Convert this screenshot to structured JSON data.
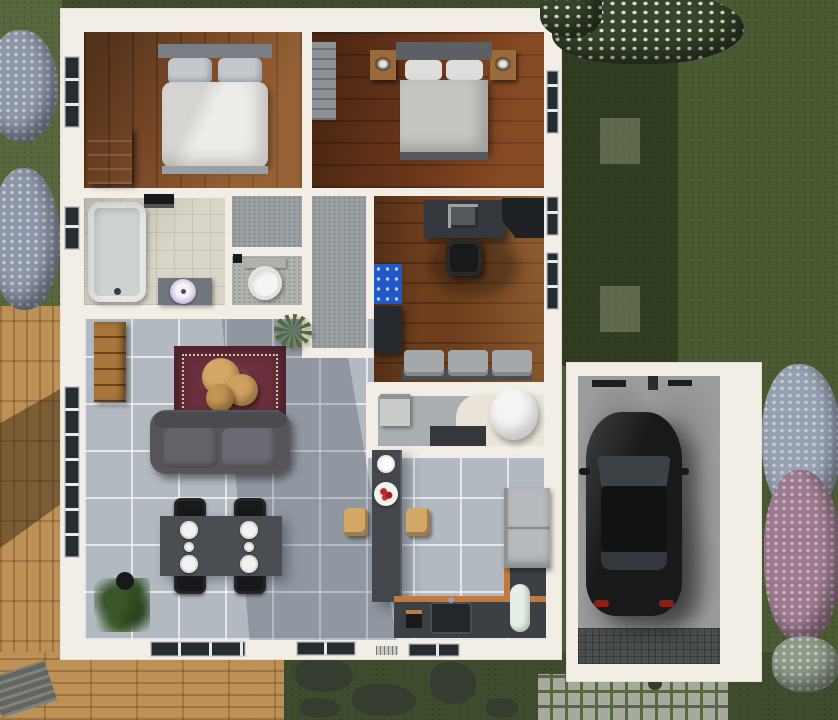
{
  "scene": {
    "kind": "3d-floorplan-render-top-view",
    "house": {
      "rooms": [
        "bedroom-left",
        "bedroom-right",
        "bathroom",
        "shower-room",
        "wc",
        "hallway",
        "office",
        "utility-room",
        "living-room",
        "dining-area",
        "kitchen",
        "garage"
      ]
    },
    "exterior": [
      "lawn",
      "wood-deck",
      "doormat",
      "stepping-stones",
      "cobblestone-driveway",
      "flowering-bushes",
      "tree-canopy",
      "house-shadow"
    ],
    "furniture": {
      "bedroom-left": [
        "double-bed-white",
        "blue-dresser",
        "window"
      ],
      "bedroom-right": [
        "double-bed-gray",
        "nightstand-left",
        "nightstand-right",
        "wardrobe",
        "window"
      ],
      "bathroom": [
        "bathtub",
        "vanity-round-sink",
        "towel-rack",
        "window"
      ],
      "shower-room": [
        "glass-screen",
        "door-handle"
      ],
      "wc": [
        "toilet"
      ],
      "office": [
        "desk",
        "printer",
        "office-chair",
        "corner-cabinet",
        "tool-board",
        "side-table",
        "bench-seats",
        "windows"
      ],
      "utility-room": [
        "washing-machine",
        "counter",
        "toilet-basin",
        "platform"
      ],
      "living-room": [
        "sofa",
        "oriental-rug",
        "nesting-coffee-tables",
        "bookshelf",
        "potted-plant-small",
        "potted-plant-large",
        "glass-door"
      ],
      "dining-area": [
        "dining-table",
        "dining-chairs-x4",
        "place-settings"
      ],
      "kitchen": [
        "island",
        "fruit-plate",
        "white-bowl",
        "bar-stools-x2",
        "counter-bottom",
        "counter-right",
        "sink",
        "refrigerator",
        "dishwasher",
        "coffee-maker",
        "vent"
      ],
      "garage": [
        "black-car",
        "floor-mat",
        "wall-tools",
        "concrete-floor"
      ]
    }
  },
  "palette": {
    "grass": "#4a5a33",
    "grassLight": "#57673e",
    "grassDark": "#3f4d2e",
    "deck": "#bd9055",
    "wall": "#f3eee5",
    "glass": "#272c31",
    "woodA": "#7b4a27",
    "woodB": "#70391b",
    "woodC": "#6f3f1d",
    "tile": "#b2b9c1",
    "bathTile": "#d8d4c8",
    "grayTile": "#9ba1a3",
    "wcTile": "#b0b2ac",
    "utilTile": "#a9afb1",
    "sofa": "#55555a",
    "rug": "#6b2f3d",
    "rugDark": "#4f222d",
    "tan": "#d3a766",
    "dining": "#4a4e52",
    "black": "#17191b",
    "bedWhite": "#eeedea",
    "pillow": "#c3c8cd",
    "headboardA": "#787e84",
    "bedGray": "#c6c6c1",
    "headboardB": "#5c6065",
    "nightWood": "#9a6a3a",
    "dresser": "#2c4577",
    "wardrobe": "#8e9296",
    "tub": "#cdd2ce",
    "white": "#f4f5f2",
    "sinkLavender": "#cab9dd",
    "desk": "#34383c",
    "cabinet": "#1e2225",
    "toolBlue": "#2158c8",
    "bench": "#a4a8ab",
    "island": "#43474c",
    "counter": "#3c4044",
    "counterEdge": "#c07a3e",
    "fridge": "#b7babc",
    "mint": "#e4efe7",
    "concrete": "#9a9c9b",
    "mat": "#4b4e4f",
    "cobble": "#a6a99e",
    "bushBlue": "#8d96a8",
    "bushPink": "#9c7b8e",
    "canopy": "#36452a",
    "blossom": "#e3e8dd",
    "carGlass": "#3c4146",
    "taillight": "#8a1f14",
    "stone": "#353c30",
    "bookshelf": "#a8763c"
  }
}
